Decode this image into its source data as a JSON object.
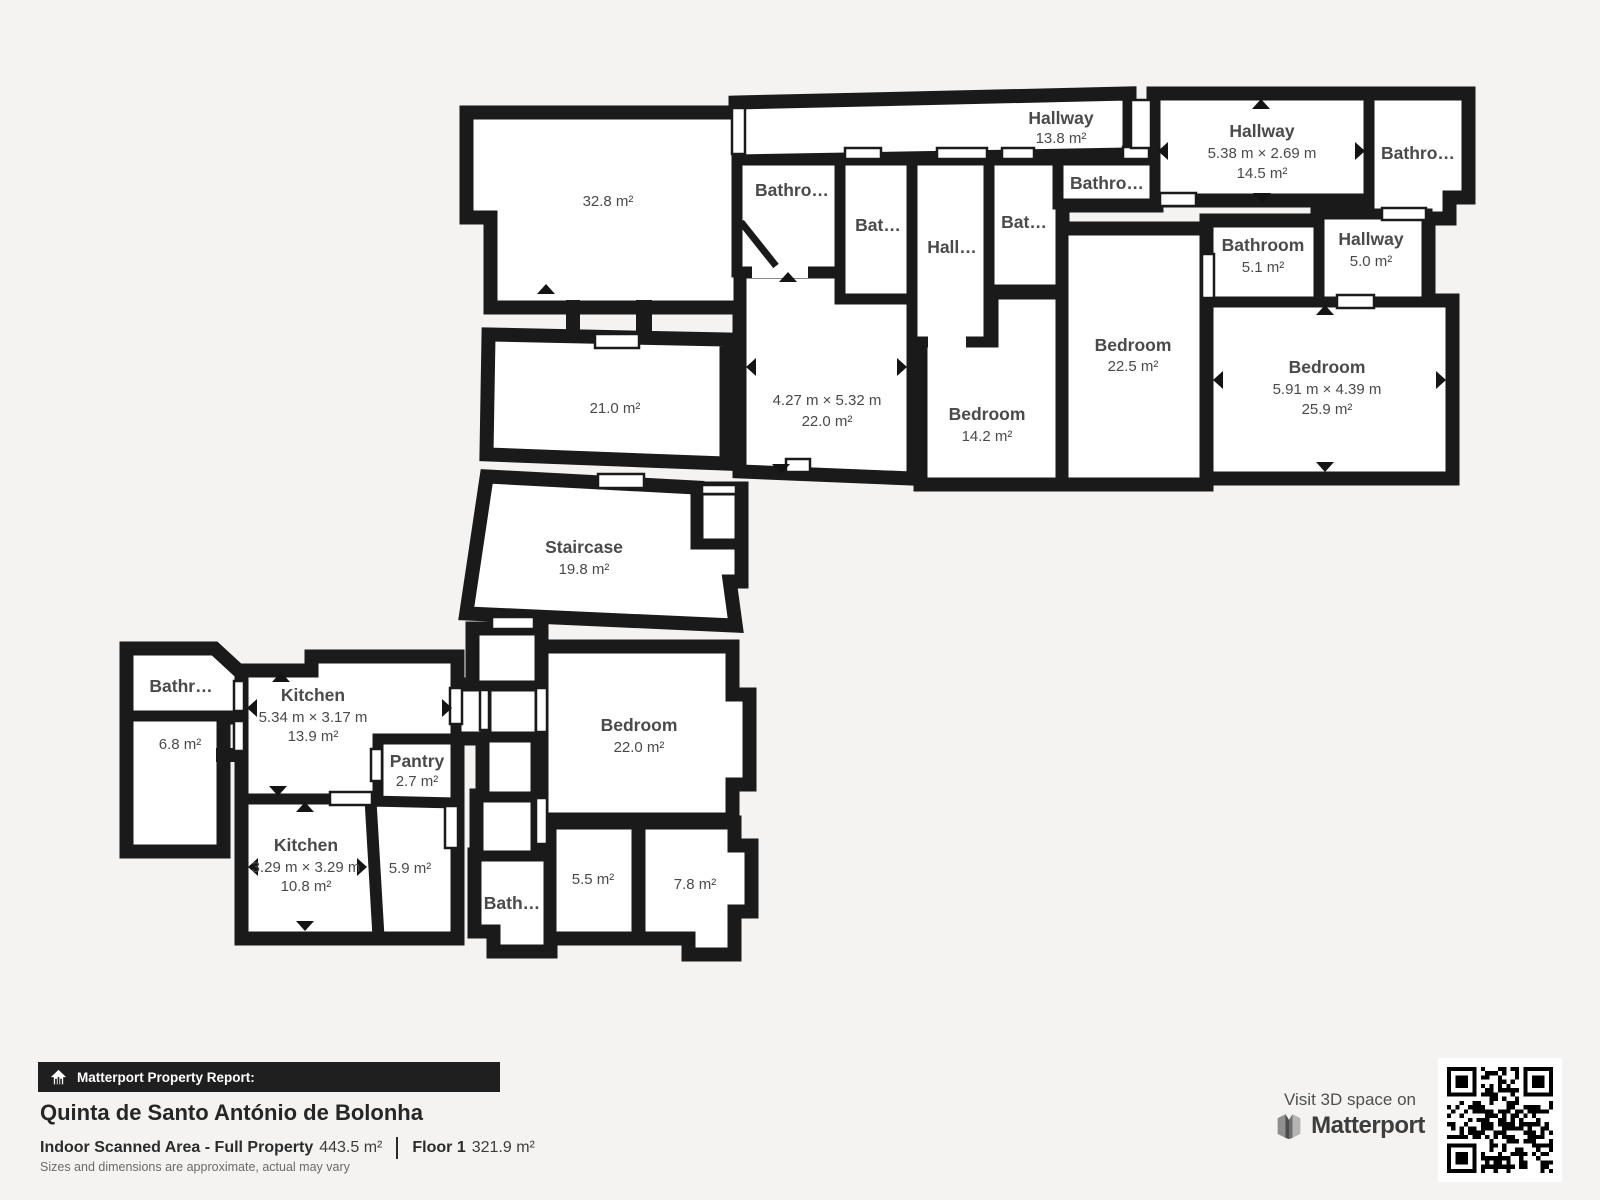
{
  "page": {
    "background": "#f4f3f1",
    "wall_color": "#1a1a1a",
    "room_fill": "#ffffff",
    "label_color": "#4a4a4a"
  },
  "floor": {
    "rooms": [
      {
        "id": "room-32-8",
        "area": "32.8 m²"
      },
      {
        "id": "room-21-0",
        "area": "21.0 m²"
      },
      {
        "id": "staircase",
        "name": "Staircase",
        "area": "19.8 m²"
      },
      {
        "id": "hallway-13-8",
        "name": "Hallway",
        "area": "13.8 m²"
      },
      {
        "id": "hallway-14-5",
        "name": "Hallway",
        "dims": "5.38 m × 2.69 m",
        "area": "14.5 m²"
      },
      {
        "id": "bathroom-top-right",
        "name": "Bathro…"
      },
      {
        "id": "bathroom-a",
        "name": "Bathro…"
      },
      {
        "id": "bathroom-b",
        "name": "Bat…"
      },
      {
        "id": "hall-small",
        "name": "Hall…"
      },
      {
        "id": "bathroom-c",
        "name": "Bat…"
      },
      {
        "id": "bathroom-d",
        "name": "Bathro…"
      },
      {
        "id": "bathroom-5-1",
        "name": "Bathroom",
        "area": "5.1 m²"
      },
      {
        "id": "hallway-5-0",
        "name": "Hallway",
        "area": "5.0 m²"
      },
      {
        "id": "room-22-0",
        "dims": "4.27 m × 5.32 m",
        "area": "22.0 m²"
      },
      {
        "id": "bedroom-14-2",
        "name": "Bedroom",
        "area": "14.2 m²"
      },
      {
        "id": "bedroom-22-5",
        "name": "Bedroom",
        "area": "22.5 m²"
      },
      {
        "id": "bedroom-25-9",
        "name": "Bedroom",
        "dims": "5.91 m × 4.39 m",
        "area": "25.9 m²"
      },
      {
        "id": "bathroom-left",
        "name": "Bathr…"
      },
      {
        "id": "room-6-8",
        "area": "6.8 m²"
      },
      {
        "id": "kitchen-13-9",
        "name": "Kitchen",
        "dims": "5.34 m × 3.17 m",
        "area": "13.9 m²"
      },
      {
        "id": "pantry",
        "name": "Pantry",
        "area": "2.7 m²"
      },
      {
        "id": "kitchen-10-8",
        "name": "Kitchen",
        "dims": "3.29 m × 3.29 m",
        "area": "10.8 m²"
      },
      {
        "id": "room-5-9",
        "area": "5.9 m²"
      },
      {
        "id": "bathroom-bottom",
        "name": "Bath…"
      },
      {
        "id": "room-5-5",
        "area": "5.5 m²"
      },
      {
        "id": "room-7-8",
        "area": "7.8 m²"
      },
      {
        "id": "bedroom-22-0b",
        "name": "Bedroom",
        "area": "22.0 m²"
      }
    ]
  },
  "report": {
    "banner_label": "Matterport Property Report:",
    "property_name": "Quinta de Santo António de Bolonha",
    "area_label": "Indoor Scanned Area - Full Property",
    "area_value": "443.5 m²",
    "floor_label": "Floor 1",
    "floor_value": "321.9 m²",
    "disclaimer": "Sizes and dimensions are approximate, actual may vary"
  },
  "branding": {
    "visit_text": "Visit 3D space on",
    "brand_name": "Matterport",
    "icons": {
      "banner": "house-report-icon",
      "logo": "matterport-m-icon",
      "qr": "qr-code"
    }
  }
}
